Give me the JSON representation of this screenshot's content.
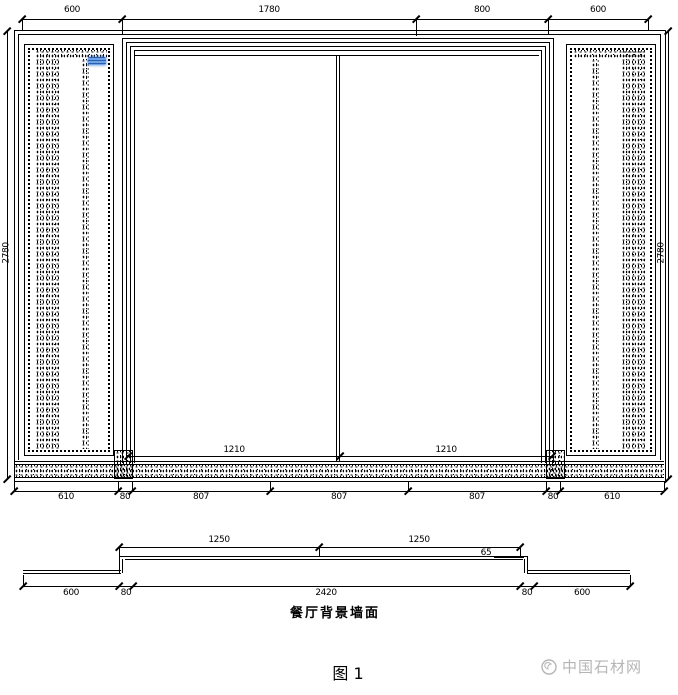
{
  "figure": {
    "caption": "图 1"
  },
  "watermark": {
    "text": "中国石材网",
    "color": "#b5b5b5"
  },
  "colors": {
    "line": "#000000",
    "highlight_blue": "#4a86d8",
    "background": "#ffffff"
  },
  "elevation": {
    "top_dims": [
      "600",
      "1780",
      "800",
      "600"
    ],
    "height_left": "2780",
    "height_right": "2780",
    "door_dims": [
      "1210",
      "1210"
    ],
    "bottom_dims": [
      "610",
      "80",
      "807",
      "807",
      "807",
      "80",
      "610"
    ]
  },
  "section": {
    "label": "餐厅背景墙面",
    "top_dims": [
      "1250",
      "1250"
    ],
    "depth": "65",
    "bottom_dims": [
      "600",
      "80",
      "2420",
      "80",
      "600"
    ]
  }
}
